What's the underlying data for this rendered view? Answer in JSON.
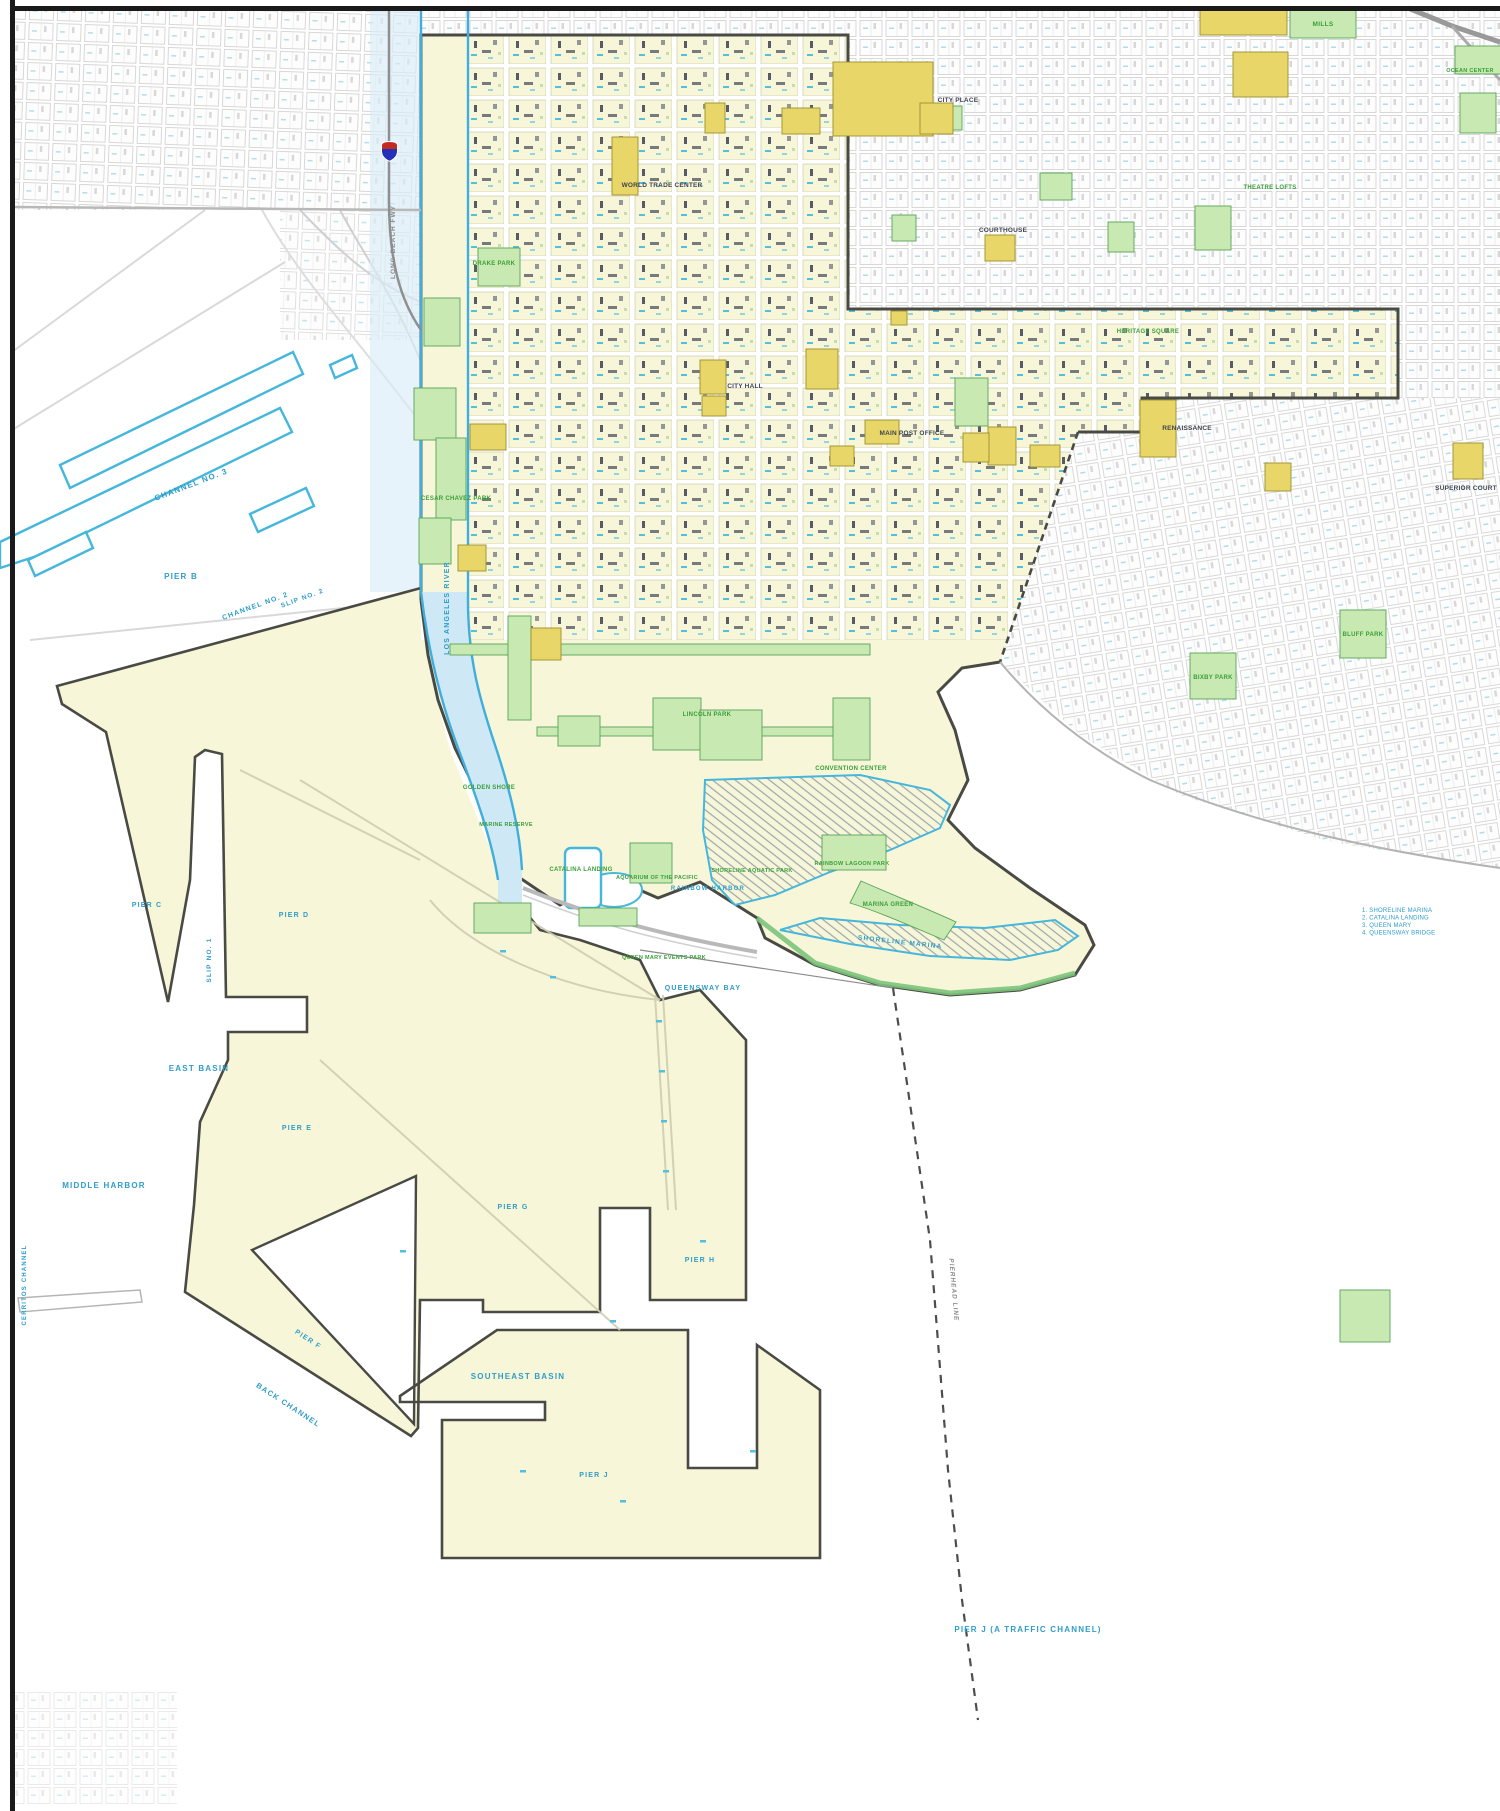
{
  "map": {
    "kind": "planned-development-district-map",
    "colors": {
      "plan_area_cream": "#f7f6d9",
      "parcel_yellow": "#e9d668",
      "park_green": "#c8e9b2",
      "water_outline_blue": "#45b6dc",
      "water_text_blue": "#2f9dc9",
      "park_text_green": "#3a9e3a",
      "boundary_gray": "#4a4a44",
      "marker_red": "#c22a22",
      "marker_blue": "#2231b8"
    },
    "marker": {
      "icon": "freeway-shield"
    }
  },
  "labels": {
    "water": [
      {
        "text": "CHANNEL NO. 3"
      },
      {
        "text": "PIER B"
      },
      {
        "text": "CHANNEL NO. 2"
      },
      {
        "text": "SLIP NO. 2"
      },
      {
        "text": "PIER C"
      },
      {
        "text": "PIER D"
      },
      {
        "text": "SLIP NO. 1"
      },
      {
        "text": "EAST BASIN"
      },
      {
        "text": "MIDDLE HARBOR"
      },
      {
        "text": "BACK CHANNEL"
      },
      {
        "text": "SOUTHEAST BASIN"
      },
      {
        "text": "QUEENSWAY BAY"
      },
      {
        "text": "PIER J (A TRAFFIC CHANNEL)"
      },
      {
        "text": "LOS ANGELES RIVER"
      },
      {
        "text": "PIER E"
      },
      {
        "text": "PIER G"
      },
      {
        "text": "PIER F"
      },
      {
        "text": "PIER H"
      },
      {
        "text": "PIER J"
      },
      {
        "text": "SHORELINE MARINA"
      },
      {
        "text": "RAINBOW HARBOR"
      },
      {
        "text": "CERRITOS CHANNEL"
      }
    ],
    "parks": [
      {
        "text": "DRAKE PARK"
      },
      {
        "text": "CESAR CHAVEZ PARK"
      },
      {
        "text": "GOLDEN SHORE"
      },
      {
        "text": "MARINE RESERVE"
      },
      {
        "text": "CATALINA LANDING"
      },
      {
        "text": "AQUARIUM OF THE PACIFIC"
      },
      {
        "text": "SHORELINE AQUATIC PARK"
      },
      {
        "text": "RAINBOW LAGOON PARK"
      },
      {
        "text": "MARINA GREEN"
      },
      {
        "text": "LINCOLN PARK"
      },
      {
        "text": "CONVENTION CENTER"
      },
      {
        "text": "BIXBY PARK"
      },
      {
        "text": "BLUFF PARK"
      },
      {
        "text": "MILLS"
      },
      {
        "text": "OCEAN CENTER"
      },
      {
        "text": "THEATRE LOFTS"
      },
      {
        "text": "QUEEN MARY EVENTS PARK"
      },
      {
        "text": "HERITAGE SQUARE"
      }
    ],
    "places": [
      {
        "text": "CITY PLACE"
      },
      {
        "text": "WORLD TRADE CENTER"
      },
      {
        "text": "CITY HALL"
      },
      {
        "text": "MAIN POST OFFICE"
      },
      {
        "text": "COURTHOUSE"
      },
      {
        "text": "RENAISSANCE"
      },
      {
        "text": "SUPERIOR COURT"
      }
    ],
    "roads": [
      {
        "text": "LONG BEACH FWY"
      },
      {
        "text": "PIERHEAD LINE"
      }
    ],
    "notes": {
      "lines": [
        "1. SHORELINE MARINA",
        "2. CATALINA LANDING",
        "3. QUEEN MARY",
        "4. QUEENSWAY BRIDGE"
      ]
    }
  }
}
